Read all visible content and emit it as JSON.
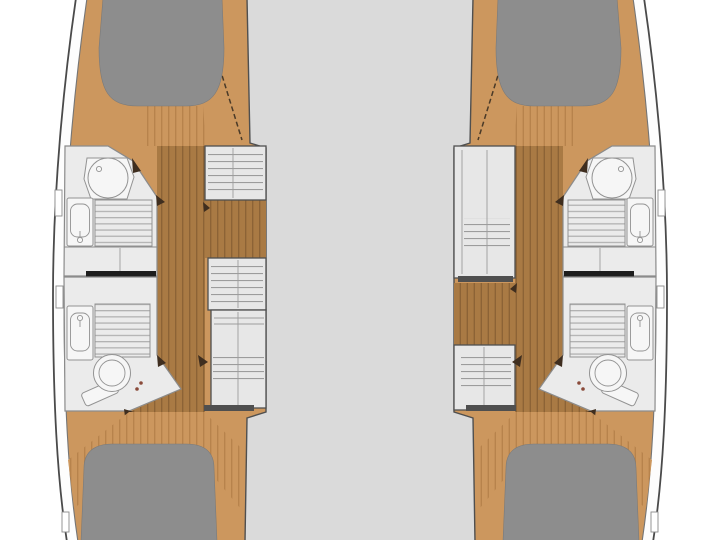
{
  "diagram": {
    "type": "floorplan",
    "subject": "catamaran interior deck plan",
    "orientation": "bow-up",
    "center_area": "bridge-deck (empty)",
    "hulls": [
      {
        "id": "port-hull",
        "side": "left",
        "sections_bow_to_stern": [
          "forward-double-berth",
          "forward-bathroom (shower stall, washbasin, teak grating)",
          "companionway-entry (forward position)",
          "steps-and-wardrobe-units",
          "sliding-door-divider",
          "aft-bathroom (washbasin, teak grating, toilet)",
          "aft-double-berth"
        ]
      },
      {
        "id": "starboard-hull",
        "side": "right",
        "sections_bow_to_stern": [
          "forward-double-berth",
          "forward-bathroom (shower stall, washbasin, teak grating)",
          "tall-cabinet-unit",
          "companionway-entry (mid position)",
          "wardrobe-unit",
          "sliding-door-divider",
          "aft-bathroom (washbasin, teak grating, toilet)",
          "aft-double-berth"
        ]
      }
    ],
    "fixture_legend": [
      "shower-stall",
      "washbasin",
      "teak-grating",
      "toilet",
      "door-swing-marker",
      "hull-window"
    ]
  },
  "colors": {
    "background": "#ffffff",
    "bridge_deck": "#dadada",
    "hull_outline": "#4a4a4a",
    "side_deck": "#fdfdfd",
    "deck_line": "#757575",
    "wood_platform": "#cc975e",
    "wood_platform_line": "#b7834c",
    "wood_floor": "#a97a44",
    "wood_floor_line": "#8c6336",
    "berth": "#8d8d8d",
    "berth_edge": "#7a7a7a",
    "room": "#ebebeb",
    "wall": "#8b8b8b",
    "wall_dark": "#4f4f4f",
    "fixture": "#f6f6f6",
    "fixture_outline": "#939393",
    "slat_line": "#b2b2b2",
    "furniture": "#e7e7e7",
    "furniture_line": "#9c9c9c",
    "furniture_outline": "#4f4f4f",
    "divider": "#1d1d1d",
    "door_marker": "#3f2e1f",
    "chine": "#4a3a28",
    "toilet_hinge": "#8a4a3a"
  }
}
